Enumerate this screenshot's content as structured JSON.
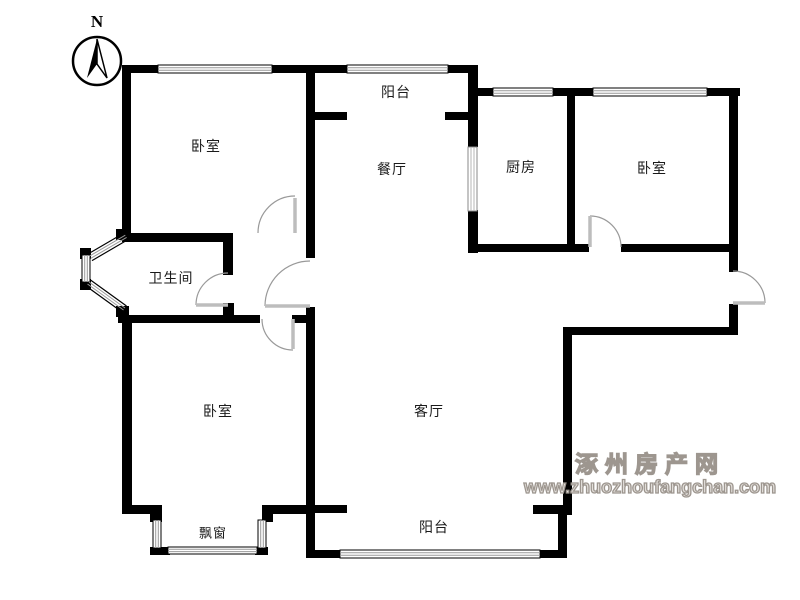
{
  "compass": {
    "north_label": "N"
  },
  "rooms": {
    "bedroom_top_left": "卧室",
    "balcony_top": "阳台",
    "dining": "餐厅",
    "kitchen": "厨房",
    "bedroom_top_right": "卧室",
    "bathroom": "卫生间",
    "bedroom_bottom_left": "卧室",
    "living_room": "客厅",
    "bay_window": "飘窗",
    "balcony_bottom": "阳台"
  },
  "watermark": {
    "site_name": "涿州房产网",
    "url": "www.zhuozhoufangchan.com"
  },
  "colors": {
    "wall": "#000000",
    "window_line": "#999999",
    "door_leaf": "#bdbdbd",
    "door_arc": "#999999",
    "label_text": "#1a1a1a",
    "watermark": "#9d968f"
  }
}
